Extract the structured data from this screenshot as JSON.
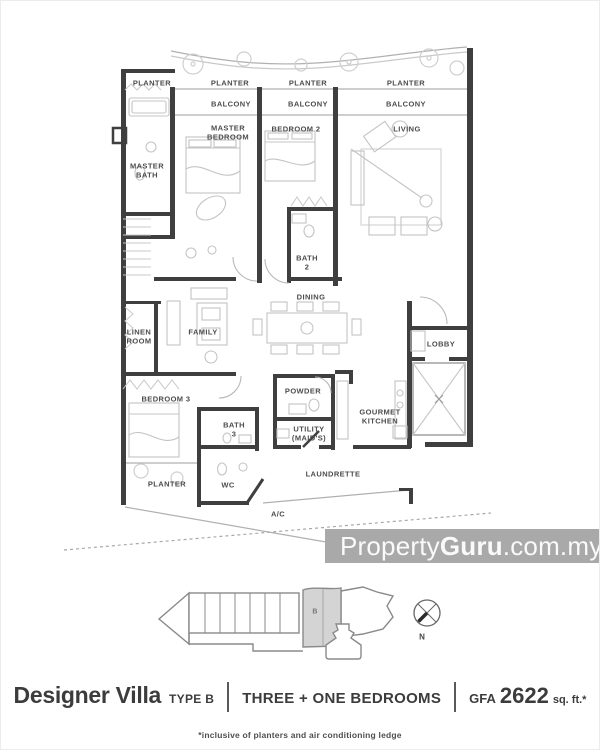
{
  "plan": {
    "room_labels": [
      {
        "text": "PLANTER"
      },
      {
        "text": "PLANTER"
      },
      {
        "text": "PLANTER"
      },
      {
        "text": "PLANTER"
      },
      {
        "text": "BALCONY"
      },
      {
        "text": "BALCONY"
      },
      {
        "text": "BALCONY"
      },
      {
        "text": "MASTER\nBEDROOM"
      },
      {
        "text": "BEDROOM 2"
      },
      {
        "text": "LIVING"
      },
      {
        "text": "MASTER\nBATH"
      },
      {
        "text": "BATH\n2"
      },
      {
        "text": "DINING"
      },
      {
        "text": "LINEN\nROOM"
      },
      {
        "text": "FAMILY"
      },
      {
        "text": "LOBBY"
      },
      {
        "text": "BEDROOM 3"
      },
      {
        "text": "POWDER"
      },
      {
        "text": "GOURMET\nKITCHEN"
      },
      {
        "text": "BATH\n3"
      },
      {
        "text": "UTILITY\n(MAID'S)"
      },
      {
        "text": "PLANTER"
      },
      {
        "text": "WC"
      },
      {
        "text": "LAUNDRETTE"
      },
      {
        "text": "A/C"
      }
    ]
  },
  "key_plan": {
    "unit": "B",
    "north": "N"
  },
  "watermark": {
    "brand_regular": "Property",
    "brand_bold": "Guru",
    "domain_suffix": ".com.my"
  },
  "title": {
    "name": "Designer Villa",
    "type": "TYPE B",
    "bedrooms": "THREE + ONE BEDROOMS",
    "gfa_label": "GFA",
    "gfa_value": "2622",
    "gfa_unit": "sq. ft.*"
  },
  "footnote": "*inclusive of planters and air conditioning ledge",
  "colors": {
    "wall": "#3f3f3f",
    "thin_line": "#b0b0b0",
    "furniture_line": "#c4c4c4",
    "watermark_bg": "#a9a9a9",
    "unit_b_fill": "#d4d4d4"
  }
}
